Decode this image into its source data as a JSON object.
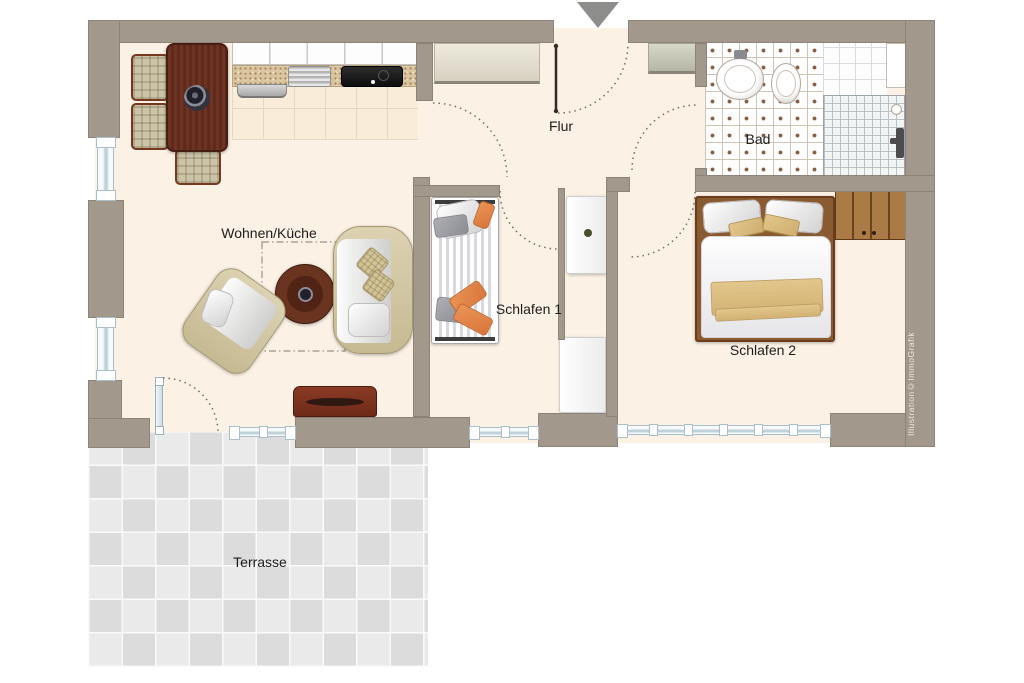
{
  "watermark": "Illustration©ImmoGrafik",
  "rooms": {
    "living": {
      "label": "Wohnen/Küche"
    },
    "hall": {
      "label": "Flur"
    },
    "bath": {
      "label": "Bad"
    },
    "bedroom1": {
      "label": "Schlafen 1"
    },
    "bedroom2": {
      "label": "Schlafen 2"
    },
    "terrace": {
      "label": "Terrasse"
    }
  },
  "icons": {
    "entrance_arrow": "triangle-down"
  },
  "colors": {
    "wall": "#a2988c",
    "floor": "#fbf1e5",
    "terrace_tile": "#eaeaea",
    "door_swing": "#7a6a58",
    "window_symbol": "#a9bec8",
    "wood_dark": "#6e3322",
    "wood_mid": "#8f5c2c",
    "accent_orange": "#e08a4e",
    "accent_tan": "#d8b97c",
    "bath_tile_dot": "#8a5c3e"
  }
}
